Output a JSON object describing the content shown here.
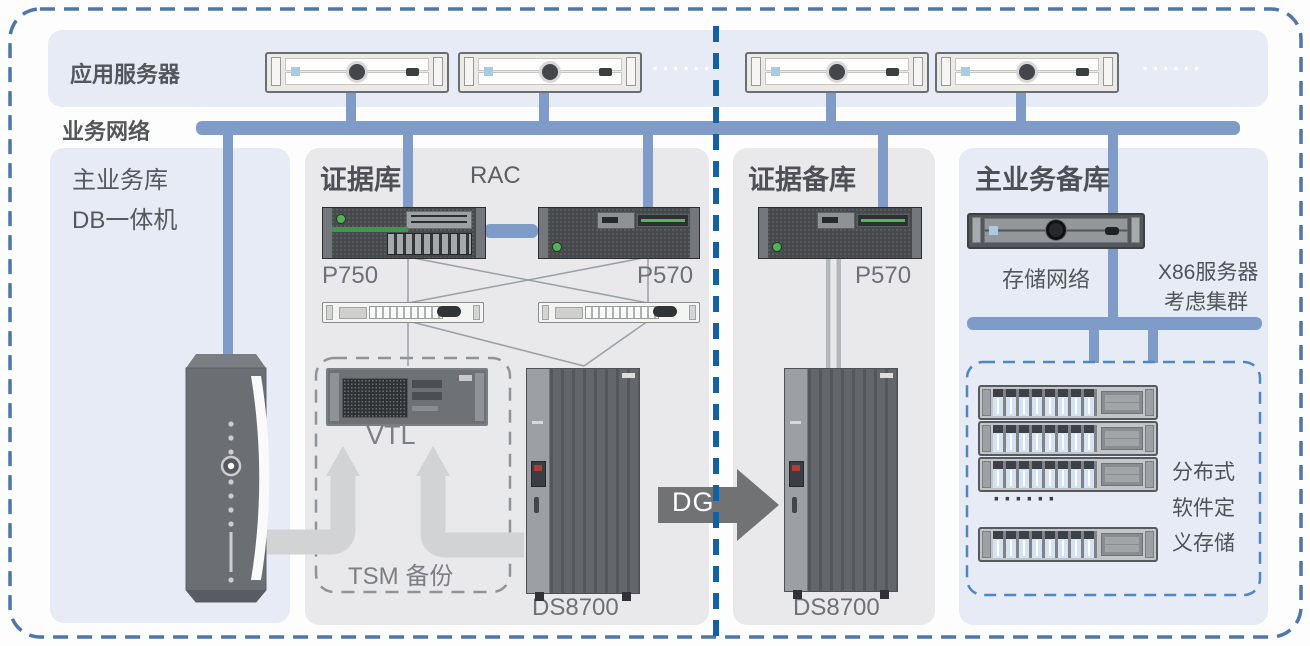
{
  "top": {
    "app_server_label": "应用服务器",
    "network_label": "业务网络",
    "dots": "······"
  },
  "left_panel": {
    "line1": "主业务库",
    "line2": "DB一体机"
  },
  "evidence_db": {
    "title": "证据库",
    "rac": "RAC",
    "p750": "P750",
    "p570": "P570",
    "vtl": "VTL",
    "tsm": "TSM 备份",
    "ds8700": "DS8700"
  },
  "dg": {
    "label": "DG"
  },
  "evidence_backup": {
    "title": "证据备库",
    "p570": "P570",
    "ds8700": "DS8700"
  },
  "main_backup": {
    "title": "主业务备库",
    "storage_network": "存储网络",
    "x86_line1": "X86服务器",
    "x86_line2": "考虑集群",
    "dots": "······",
    "sds_line1": "分布式",
    "sds_line2": "软件定",
    "sds_line3": "义存储"
  },
  "colors": {
    "panel_blue": "#e6ebf6",
    "panel_gray": "#e9e9eb",
    "network_bar": "#7f9cc9",
    "divider_blue": "#1361a2",
    "outer_border": "#4f76a8",
    "sds_box_border": "#4e86c6",
    "dg_arrow": "#707274"
  }
}
